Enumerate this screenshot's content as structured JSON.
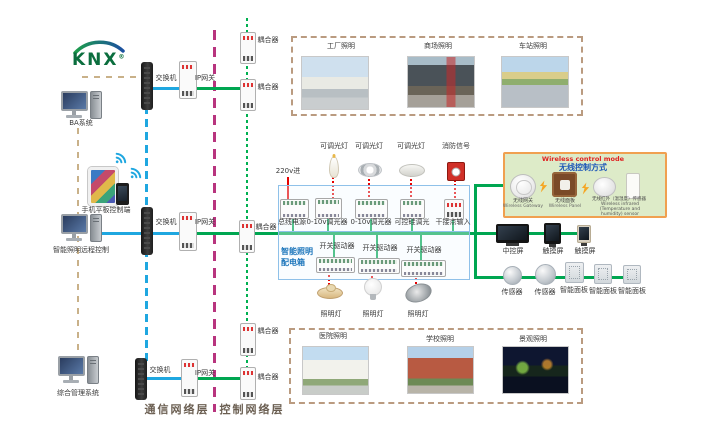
{
  "logo": {
    "text": "KNX",
    "mark": "®"
  },
  "labels": {
    "switch": "交换机",
    "ip_gateway": "IP网关",
    "coupler": "耦合器",
    "ba_system": "BA系统",
    "mobile_control": "手机平板控制端",
    "remote_control": "智能照明远程控制",
    "management_system": "综合管理系统"
  },
  "layer_labels": {
    "communication": "通信网络层",
    "control": "控制网络层"
  },
  "scenes": {
    "top": [
      {
        "label": "工厂照明"
      },
      {
        "label": "商场照明"
      },
      {
        "label": "车站照明"
      }
    ],
    "bottom": [
      {
        "label": "医院照明"
      },
      {
        "label": "学校照明"
      },
      {
        "label": "景观照明"
      }
    ]
  },
  "panel": {
    "title_line1": "智能照明",
    "title_line2": "配电箱",
    "power_in": "220v进",
    "top_loads": [
      "可调光灯",
      "可调光灯",
      "可调光灯",
      "消防信号"
    ],
    "top_devices": [
      "总线电源",
      "0-10v调光器",
      "0-10v调光器",
      "可控硅调光",
      "干接点输入"
    ],
    "bottom_devices": [
      "开关驱动器",
      "开关驱动器",
      "开关驱动器"
    ],
    "bottom_loads": [
      "照明灯",
      "照明灯",
      "照明灯"
    ]
  },
  "wireless": {
    "title_en": "Wireless control mode",
    "title_zh": "无线控制方式",
    "items": [
      {
        "zh": "无线网关",
        "en": "Wireless Gateway"
      },
      {
        "zh": "无线面板",
        "en": "Wireless Panel"
      },
      {
        "zh": "无线红外（温湿度）传感器",
        "en": "Wireless infrared (Temperature and humidity) sensor"
      }
    ]
  },
  "right_devices": {
    "row1": [
      "中控屏",
      "触摸屏",
      "触摸屏"
    ],
    "row2": [
      "传感器",
      "传感器",
      "智能面板",
      "智能面板",
      "智能面板"
    ]
  },
  "colors": {
    "bus_green": "#00A651",
    "ethernet_blue": "#1FA7E0",
    "layer_divider_magenta": "#B8347E",
    "power_red": "#E60000",
    "frame_tan": "#BA9B80",
    "wireless_bg": "#DDEBC8",
    "wireless_border": "#F0A050",
    "panel_border": "#8FC1E9",
    "panel_title_blue": "#1B75BB"
  }
}
